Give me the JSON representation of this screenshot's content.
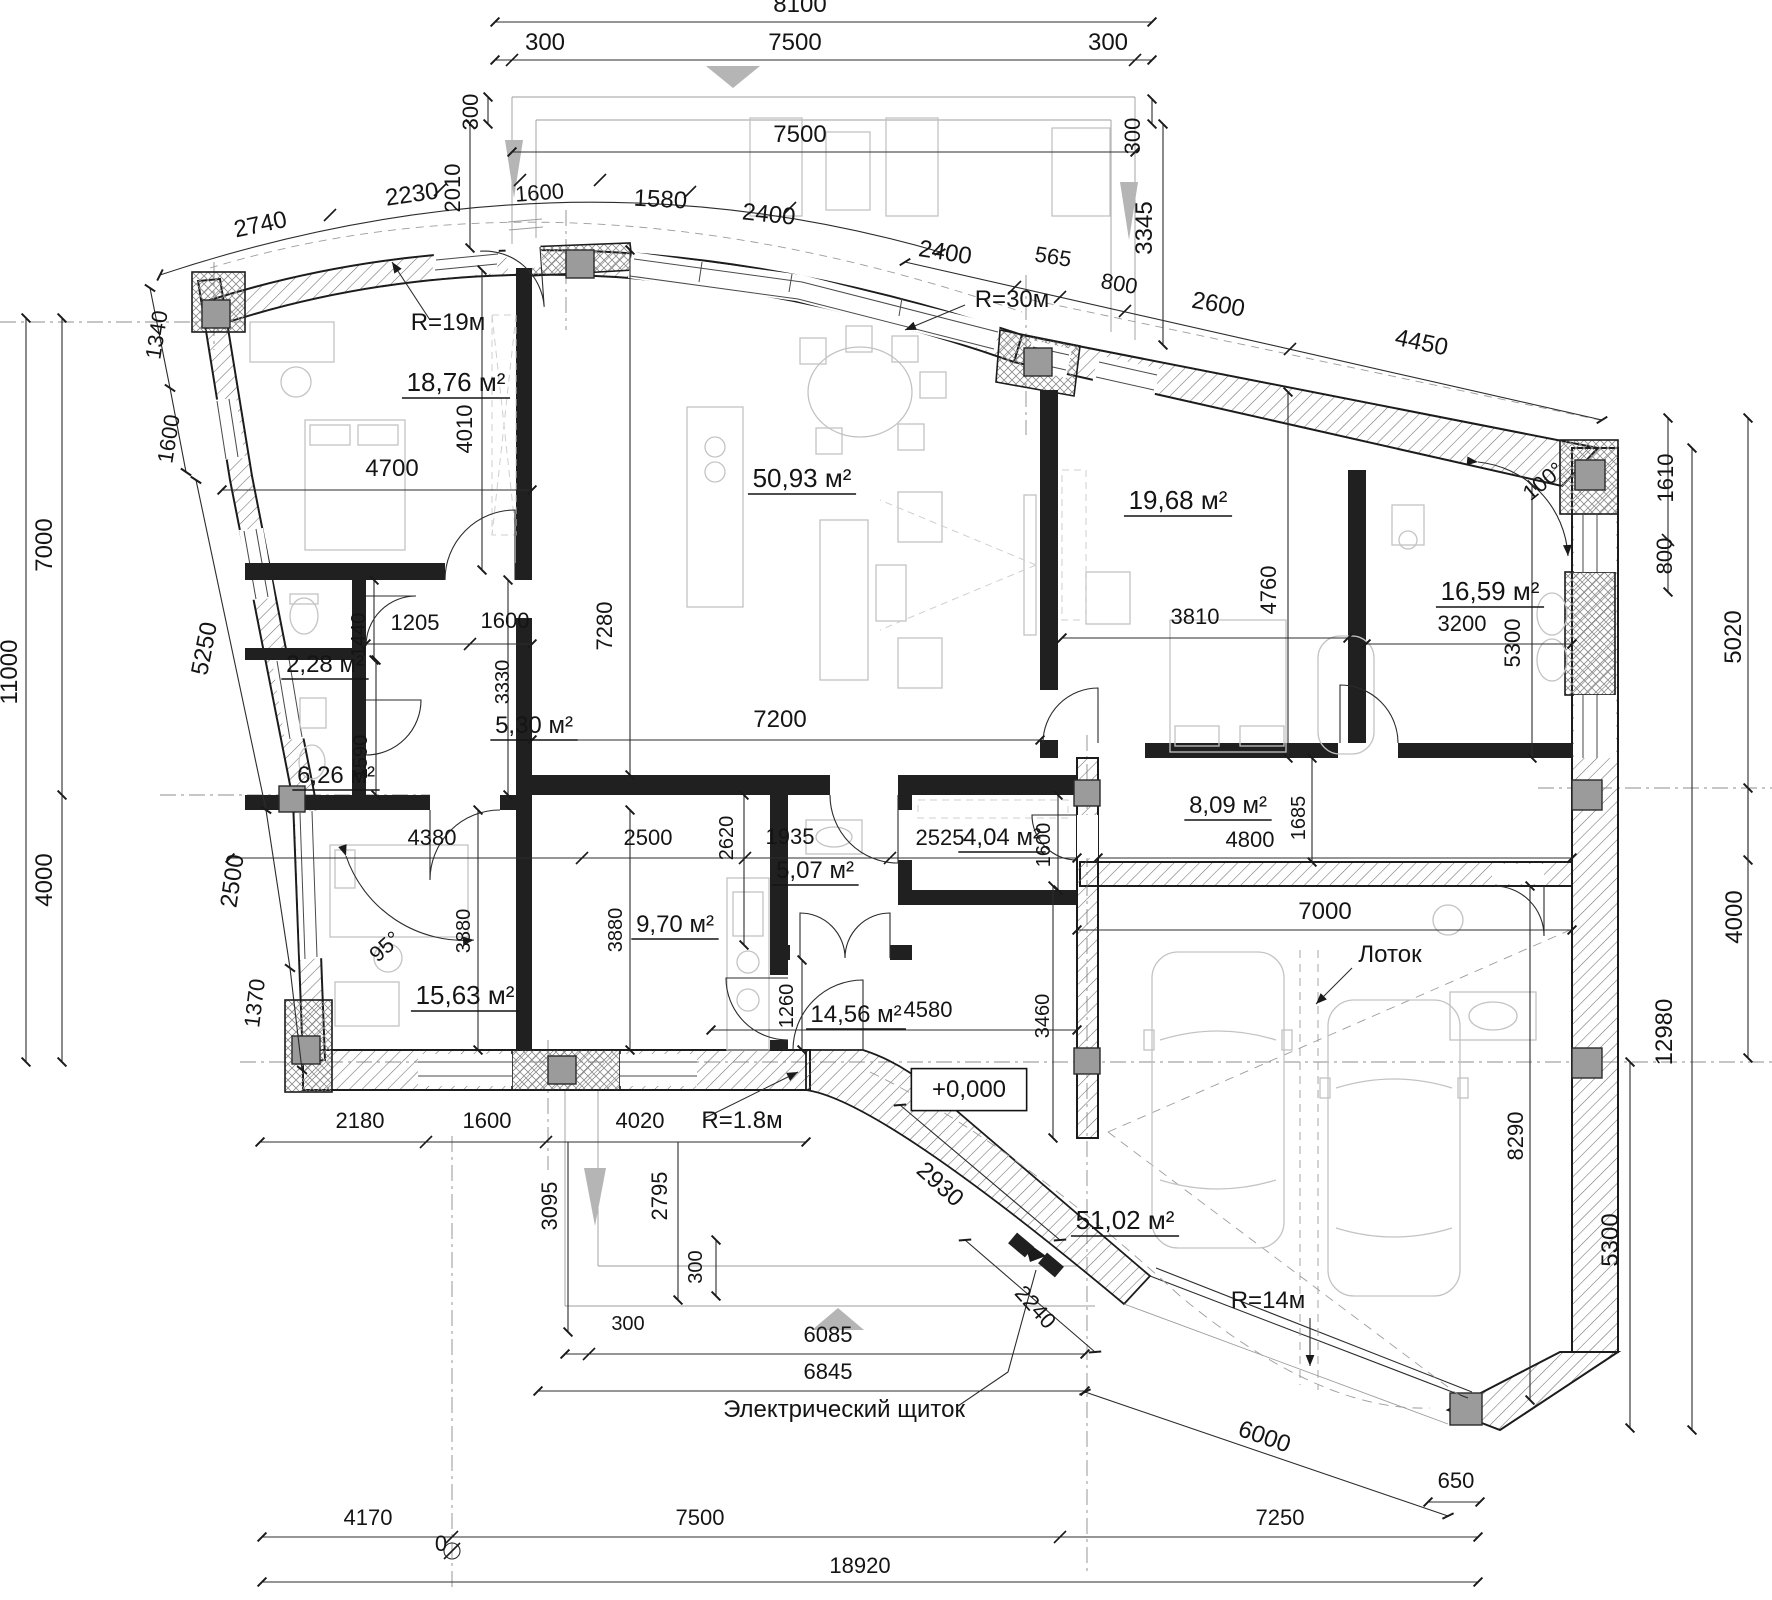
{
  "meta": {
    "drawing_type": "architectural floor plan",
    "language": "ru",
    "elevation_mark": "+0,000",
    "total_width_label": "18920",
    "notes": [
      "Лоток",
      "Электрический щиток"
    ],
    "radii": [
      "R=19м",
      "R=30м",
      "R=1.8м",
      "R=14м"
    ],
    "angles": [
      "95°",
      "100°"
    ]
  },
  "colors": {
    "background": "#ffffff",
    "wall_line": "#1c1c1c",
    "column_fill": "#9b9b9b",
    "furniture": "#c3c3c3",
    "dimension": "#2c2c2c",
    "arrow_gray": "#b5b5b5"
  },
  "rooms": [
    {
      "name": "bedroom-top-left",
      "area": "18,76 м²"
    },
    {
      "name": "living-dining",
      "area": "50,93 м²"
    },
    {
      "name": "bedroom-right",
      "area": "19,68 м²"
    },
    {
      "name": "bathroom-right",
      "area": "16,59 м²"
    },
    {
      "name": "wc-small",
      "area": "2,28 м²"
    },
    {
      "name": "hall-small",
      "area": "5,30 м²"
    },
    {
      "name": "bathroom-left",
      "area": "6,26 м²"
    },
    {
      "name": "corridor-garage",
      "area": "8,09 м²"
    },
    {
      "name": "storage",
      "area": "4,04 м²"
    },
    {
      "name": "wc-central",
      "area": "5,07 м²"
    },
    {
      "name": "kitchen",
      "area": "9,70 м²"
    },
    {
      "name": "bedroom-bottom-left",
      "area": "15,63 м²"
    },
    {
      "name": "hallway-central",
      "area": "14,56 м²"
    },
    {
      "name": "garage",
      "area": "51,02 м²"
    }
  ],
  "annotations": [
    {
      "t": "8100",
      "x": 800,
      "y": 12,
      "r": 0,
      "s": 24,
      "k": "dim"
    },
    {
      "t": "300",
      "x": 545,
      "y": 50,
      "r": 0,
      "s": 24,
      "k": "dim"
    },
    {
      "t": "7500",
      "x": 795,
      "y": 50,
      "r": 0,
      "s": 24,
      "k": "dim"
    },
    {
      "t": "300",
      "x": 1108,
      "y": 50,
      "r": 0,
      "s": 24,
      "k": "dim"
    },
    {
      "t": "7500",
      "x": 800,
      "y": 142,
      "r": 0,
      "s": 24,
      "k": "dim"
    },
    {
      "t": "300",
      "x": 478,
      "y": 112,
      "r": -90,
      "s": 22,
      "k": "dim"
    },
    {
      "t": "2010",
      "x": 460,
      "y": 188,
      "r": -90,
      "s": 22,
      "k": "dim"
    },
    {
      "t": "300",
      "x": 1140,
      "y": 136,
      "r": -90,
      "s": 22,
      "k": "dim"
    },
    {
      "t": "3345",
      "x": 1152,
      "y": 228,
      "r": -90,
      "s": 24,
      "k": "dim"
    },
    {
      "t": "2740",
      "x": 262,
      "y": 232,
      "r": -12,
      "s": 24,
      "k": "dim"
    },
    {
      "t": "2230",
      "x": 413,
      "y": 202,
      "r": -8,
      "s": 24,
      "k": "dim"
    },
    {
      "t": "1600",
      "x": 540,
      "y": 200,
      "r": -4,
      "s": 22,
      "k": "dim"
    },
    {
      "t": "1580",
      "x": 660,
      "y": 207,
      "r": 3,
      "s": 24,
      "k": "dim"
    },
    {
      "t": "2400",
      "x": 768,
      "y": 222,
      "r": 6,
      "s": 24,
      "k": "dim"
    },
    {
      "t": "2400",
      "x": 944,
      "y": 260,
      "r": 9,
      "s": 24,
      "k": "dim"
    },
    {
      "t": "565",
      "x": 1052,
      "y": 264,
      "r": 9,
      "s": 22,
      "k": "dim"
    },
    {
      "t": "800",
      "x": 1118,
      "y": 291,
      "r": 10,
      "s": 22,
      "k": "dim"
    },
    {
      "t": "2600",
      "x": 1217,
      "y": 312,
      "r": 10,
      "s": 24,
      "k": "dim"
    },
    {
      "t": "4450",
      "x": 1420,
      "y": 350,
      "r": 12,
      "s": 24,
      "k": "dim"
    },
    {
      "t": "R=19м",
      "x": 448,
      "y": 330,
      "r": 0,
      "s": 24,
      "k": "note"
    },
    {
      "t": "R=30м",
      "x": 1012,
      "y": 307,
      "r": 0,
      "s": 24,
      "k": "note"
    },
    {
      "t": "1340",
      "x": 164,
      "y": 336,
      "r": -81,
      "s": 22,
      "k": "dim"
    },
    {
      "t": "1600",
      "x": 176,
      "y": 440,
      "r": -81,
      "s": 22,
      "k": "dim"
    },
    {
      "t": "7000",
      "x": 52,
      "y": 545,
      "r": -90,
      "s": 24,
      "k": "dim"
    },
    {
      "t": "11000",
      "x": 17,
      "y": 672,
      "r": -90,
      "s": 24,
      "k": "dim"
    },
    {
      "t": "5250",
      "x": 212,
      "y": 650,
      "r": -79,
      "s": 24,
      "k": "dim"
    },
    {
      "t": "2500",
      "x": 240,
      "y": 882,
      "r": -82,
      "s": 24,
      "k": "dim"
    },
    {
      "t": "4000",
      "x": 52,
      "y": 880,
      "r": -90,
      "s": 24,
      "k": "dim"
    },
    {
      "t": "1370",
      "x": 262,
      "y": 1004,
      "r": -83,
      "s": 22,
      "k": "dim"
    },
    {
      "t": "18,76 м²",
      "x": 456,
      "y": 391,
      "r": 0,
      "s": 26,
      "k": "room",
      "u": true
    },
    {
      "t": "50,93 м²",
      "x": 802,
      "y": 487,
      "r": 0,
      "s": 26,
      "k": "room",
      "u": true
    },
    {
      "t": "19,68 м²",
      "x": 1178,
      "y": 509,
      "r": 0,
      "s": 26,
      "k": "room",
      "u": true
    },
    {
      "t": "16,59 м²",
      "x": 1490,
      "y": 600,
      "r": 0,
      "s": 26,
      "k": "room",
      "u": true
    },
    {
      "t": "2,28 м²",
      "x": 325,
      "y": 672,
      "r": 0,
      "s": 24,
      "k": "room",
      "u": true
    },
    {
      "t": "5,30 м²",
      "x": 534,
      "y": 733,
      "r": 0,
      "s": 24,
      "k": "room",
      "u": true
    },
    {
      "t": "6,26 м²",
      "x": 336,
      "y": 783,
      "r": 0,
      "s": 24,
      "k": "room",
      "u": true
    },
    {
      "t": "8,09 м²",
      "x": 1228,
      "y": 813,
      "r": 0,
      "s": 24,
      "k": "room",
      "u": true
    },
    {
      "t": "4,04 м²",
      "x": 1002,
      "y": 845,
      "r": 0,
      "s": 24,
      "k": "room",
      "u": true
    },
    {
      "t": "5,07 м²",
      "x": 815,
      "y": 878,
      "r": 0,
      "s": 24,
      "k": "room",
      "u": true
    },
    {
      "t": "9,70 м²",
      "x": 675,
      "y": 932,
      "r": 0,
      "s": 24,
      "k": "room",
      "u": true
    },
    {
      "t": "15,63 м²",
      "x": 465,
      "y": 1004,
      "r": 0,
      "s": 26,
      "k": "room",
      "u": true
    },
    {
      "t": "14,56 м²",
      "x": 856,
      "y": 1022,
      "r": 0,
      "s": 24,
      "k": "room",
      "u": true
    },
    {
      "t": "51,02 м²",
      "x": 1125,
      "y": 1229,
      "r": 0,
      "s": 26,
      "k": "room",
      "u": true
    },
    {
      "t": "4010",
      "x": 472,
      "y": 429,
      "r": -90,
      "s": 22,
      "k": "dim"
    },
    {
      "t": "4700",
      "x": 392,
      "y": 476,
      "r": 0,
      "s": 24,
      "k": "dim"
    },
    {
      "t": "1440",
      "x": 365,
      "y": 635,
      "r": -90,
      "s": 20,
      "k": "dim"
    },
    {
      "t": "1205",
      "x": 415,
      "y": 630,
      "r": 0,
      "s": 22,
      "k": "dim"
    },
    {
      "t": "1600",
      "x": 505,
      "y": 628,
      "r": 0,
      "s": 22,
      "k": "dim"
    },
    {
      "t": "7280",
      "x": 612,
      "y": 626,
      "r": -90,
      "s": 22,
      "k": "dim"
    },
    {
      "t": "3330",
      "x": 509,
      "y": 682,
      "r": -90,
      "s": 20,
      "k": "dim"
    },
    {
      "t": "1590",
      "x": 367,
      "y": 757,
      "r": -90,
      "s": 20,
      "k": "dim"
    },
    {
      "t": "7200",
      "x": 780,
      "y": 727,
      "r": 0,
      "s": 24,
      "k": "dim"
    },
    {
      "t": "3810",
      "x": 1195,
      "y": 624,
      "r": 0,
      "s": 22,
      "k": "dim"
    },
    {
      "t": "4760",
      "x": 1276,
      "y": 590,
      "r": -90,
      "s": 22,
      "k": "dim"
    },
    {
      "t": "3200",
      "x": 1462,
      "y": 631,
      "r": 0,
      "s": 22,
      "k": "dim"
    },
    {
      "t": "5300",
      "x": 1520,
      "y": 643,
      "r": -90,
      "s": 22,
      "k": "dim"
    },
    {
      "t": "1610",
      "x": 1673,
      "y": 478,
      "r": -90,
      "s": 22,
      "k": "dim"
    },
    {
      "t": "800",
      "x": 1672,
      "y": 556,
      "r": -90,
      "s": 22,
      "k": "dim"
    },
    {
      "t": "5020",
      "x": 1741,
      "y": 637,
      "r": -90,
      "s": 24,
      "k": "dim"
    },
    {
      "t": "100°",
      "x": 1548,
      "y": 487,
      "r": -40,
      "s": 22,
      "k": "angle"
    },
    {
      "t": "4380",
      "x": 432,
      "y": 845,
      "r": 0,
      "s": 22,
      "k": "dim"
    },
    {
      "t": "2500",
      "x": 648,
      "y": 845,
      "r": 0,
      "s": 22,
      "k": "dim"
    },
    {
      "t": "2620",
      "x": 733,
      "y": 838,
      "r": -90,
      "s": 20,
      "k": "dim"
    },
    {
      "t": "1935",
      "x": 790,
      "y": 844,
      "r": 0,
      "s": 22,
      "k": "dim"
    },
    {
      "t": "2525",
      "x": 940,
      "y": 845,
      "r": 0,
      "s": 22,
      "k": "dim"
    },
    {
      "t": "1600",
      "x": 1050,
      "y": 845,
      "r": -90,
      "s": 20,
      "k": "dim"
    },
    {
      "t": "1685",
      "x": 1305,
      "y": 818,
      "r": -90,
      "s": 20,
      "k": "dim"
    },
    {
      "t": "4800",
      "x": 1250,
      "y": 847,
      "r": 0,
      "s": 22,
      "k": "dim"
    },
    {
      "t": "7000",
      "x": 1325,
      "y": 919,
      "r": 0,
      "s": 24,
      "k": "dim"
    },
    {
      "t": "95°",
      "x": 390,
      "y": 952,
      "r": -42,
      "s": 22,
      "k": "angle"
    },
    {
      "t": "3880",
      "x": 470,
      "y": 931,
      "r": -90,
      "s": 20,
      "k": "dim"
    },
    {
      "t": "3880",
      "x": 622,
      "y": 930,
      "r": -90,
      "s": 20,
      "k": "dim"
    },
    {
      "t": "1260",
      "x": 793,
      "y": 1006,
      "r": -90,
      "s": 20,
      "k": "dim"
    },
    {
      "t": "4580",
      "x": 928,
      "y": 1017,
      "r": 0,
      "s": 22,
      "k": "dim"
    },
    {
      "t": "3460",
      "x": 1049,
      "y": 1016,
      "r": -90,
      "s": 20,
      "k": "dim"
    },
    {
      "t": "8290",
      "x": 1523,
      "y": 1136,
      "r": -90,
      "s": 22,
      "k": "dim"
    },
    {
      "t": "12980",
      "x": 1672,
      "y": 1032,
      "r": -90,
      "s": 24,
      "k": "dim"
    },
    {
      "t": "4000",
      "x": 1742,
      "y": 917,
      "r": -90,
      "s": 24,
      "k": "dim"
    },
    {
      "t": "5300",
      "x": 1618,
      "y": 1240,
      "r": -90,
      "s": 24,
      "k": "dim"
    },
    {
      "t": "Лоток",
      "x": 1390,
      "y": 962,
      "r": 0,
      "s": 24,
      "k": "note"
    },
    {
      "t": "+0,000",
      "x": 969,
      "y": 1097,
      "r": 0,
      "s": 24,
      "k": "elev",
      "box": true
    },
    {
      "t": "2180",
      "x": 360,
      "y": 1128,
      "r": 0,
      "s": 22,
      "k": "dim"
    },
    {
      "t": "1600",
      "x": 487,
      "y": 1128,
      "r": 0,
      "s": 22,
      "k": "dim"
    },
    {
      "t": "4020",
      "x": 640,
      "y": 1128,
      "r": 0,
      "s": 22,
      "k": "dim"
    },
    {
      "t": "R=1.8м",
      "x": 742,
      "y": 1128,
      "r": 0,
      "s": 24,
      "k": "note"
    },
    {
      "t": "3095",
      "x": 557,
      "y": 1206,
      "r": -90,
      "s": 22,
      "k": "dim"
    },
    {
      "t": "2795",
      "x": 667,
      "y": 1196,
      "r": -90,
      "s": 22,
      "k": "dim"
    },
    {
      "t": "2930",
      "x": 935,
      "y": 1190,
      "r": 42,
      "s": 24,
      "k": "dim"
    },
    {
      "t": "300",
      "x": 702,
      "y": 1267,
      "r": -90,
      "s": 20,
      "k": "dim"
    },
    {
      "t": "300",
      "x": 628,
      "y": 1330,
      "r": 0,
      "s": 20,
      "k": "dim"
    },
    {
      "t": "6085",
      "x": 828,
      "y": 1342,
      "r": 0,
      "s": 22,
      "k": "dim"
    },
    {
      "t": "6845",
      "x": 828,
      "y": 1379,
      "r": 0,
      "s": 22,
      "k": "dim"
    },
    {
      "t": "Электрический щиток",
      "x": 844,
      "y": 1417,
      "r": 0,
      "s": 24,
      "k": "note"
    },
    {
      "t": "2240",
      "x": 1030,
      "y": 1312,
      "r": 48,
      "s": 22,
      "k": "dim"
    },
    {
      "t": "R=14м",
      "x": 1268,
      "y": 1308,
      "r": 0,
      "s": 24,
      "k": "note"
    },
    {
      "t": "6000",
      "x": 1262,
      "y": 1444,
      "r": 19,
      "s": 24,
      "k": "dim"
    },
    {
      "t": "650",
      "x": 1456,
      "y": 1488,
      "r": 0,
      "s": 22,
      "k": "dim"
    },
    {
      "t": "4170",
      "x": 368,
      "y": 1525,
      "r": 0,
      "s": 22,
      "k": "dim"
    },
    {
      "t": "0",
      "x": 441,
      "y": 1551,
      "r": 0,
      "s": 22,
      "k": "dim"
    },
    {
      "t": "7500",
      "x": 700,
      "y": 1525,
      "r": 0,
      "s": 22,
      "k": "dim"
    },
    {
      "t": "7250",
      "x": 1280,
      "y": 1525,
      "r": 0,
      "s": 22,
      "k": "dim"
    },
    {
      "t": "18920",
      "x": 860,
      "y": 1573,
      "r": 0,
      "s": 22,
      "k": "dim"
    }
  ]
}
